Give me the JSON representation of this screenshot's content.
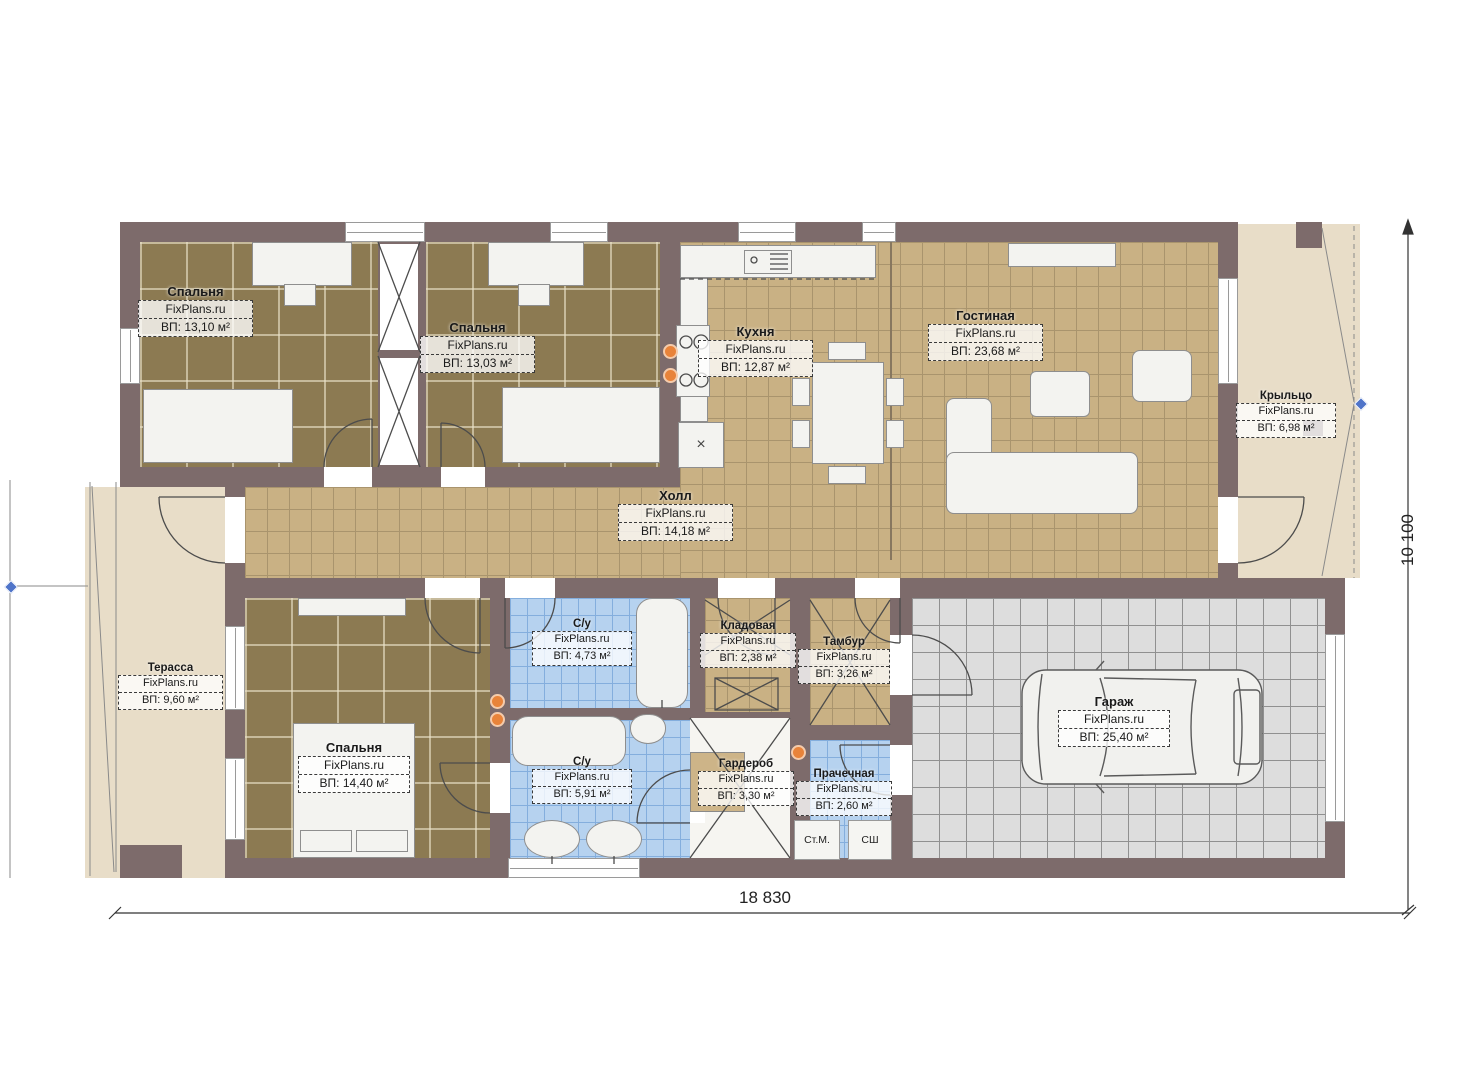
{
  "brand": "FixPlans.ru",
  "rooms": {
    "bedroom1": {
      "name": "Спальня",
      "area": "ВП: 13,10 м²"
    },
    "bedroom2": {
      "name": "Спальня",
      "area": "ВП: 13,03 м²"
    },
    "kitchen": {
      "name": "Кухня",
      "area": "ВП: 12,87 м²"
    },
    "living": {
      "name": "Гостиная",
      "area": "ВП: 23,68 м²"
    },
    "porch": {
      "name": "Крыльцо",
      "area": "ВП: 6,98 м²"
    },
    "hall": {
      "name": "Холл",
      "area": "ВП: 14,18 м²"
    },
    "terrace": {
      "name": "Терасса",
      "area": "ВП: 9,60 м²"
    },
    "bedroom3": {
      "name": "Спальня",
      "area": "ВП: 14,40 м²"
    },
    "bath1": {
      "name": "С/у",
      "area": "ВП: 4,73 м²"
    },
    "storage": {
      "name": "Кладовая",
      "area": "ВП: 2,38 м²"
    },
    "vestibule": {
      "name": "Тамбур",
      "area": "ВП: 3,26 м²"
    },
    "bath2": {
      "name": "С/у",
      "area": "ВП: 5,91 м²"
    },
    "wardrobe": {
      "name": "Гардероб",
      "area": "ВП: 3,30 м²"
    },
    "laundry": {
      "name": "Прачечная",
      "area": "ВП: 2,60 м²"
    },
    "garage": {
      "name": "Гараж",
      "area": "ВП: 25,40 м²"
    }
  },
  "appliances": {
    "washer": "Ст.М.",
    "dryer": "СШ"
  },
  "dimensions": {
    "width": "18 830",
    "height": "10 100"
  },
  "symbols": {
    "cabinet_x": "×"
  },
  "colors": {
    "wall": "#7d6b6b",
    "floor_tan": "#c9b184",
    "floor_brown": "#8c7a52",
    "floor_blue": "#b6d2ef",
    "floor_grey": "#dddddd",
    "outdoor": "#e8ddc8",
    "outlet": "#e8833a",
    "marker": "#4f74c9"
  }
}
